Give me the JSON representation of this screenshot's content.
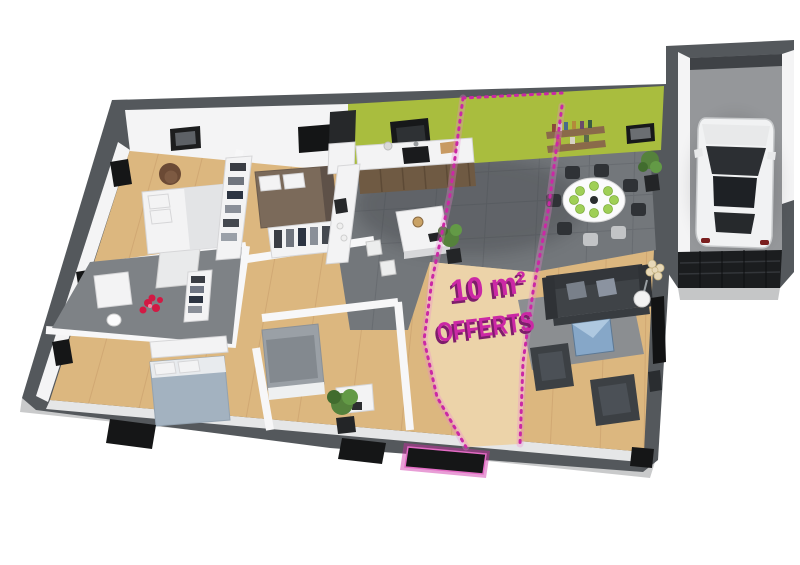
{
  "overlay": {
    "line1": "10 m²",
    "line2": "OFFERTS"
  },
  "colors": {
    "accent": "#cb28a5",
    "accent_dark": "#7e1d6b",
    "accent_glow": "#ef86d4",
    "green_wall": "#a9bd3e",
    "wood_floor": "#dcb77f",
    "wood_light": "#ecd3a9",
    "tile_floor": "#73777b",
    "wall_dark": "#54585c",
    "wall_white": "#f4f4f5",
    "garage_floor": "#95979a",
    "black_opening": "#151617",
    "sofa_dark": "#3f4347",
    "table_blue": "#86a7c8",
    "plant_green": "#55823c",
    "background": "#ffffff"
  }
}
